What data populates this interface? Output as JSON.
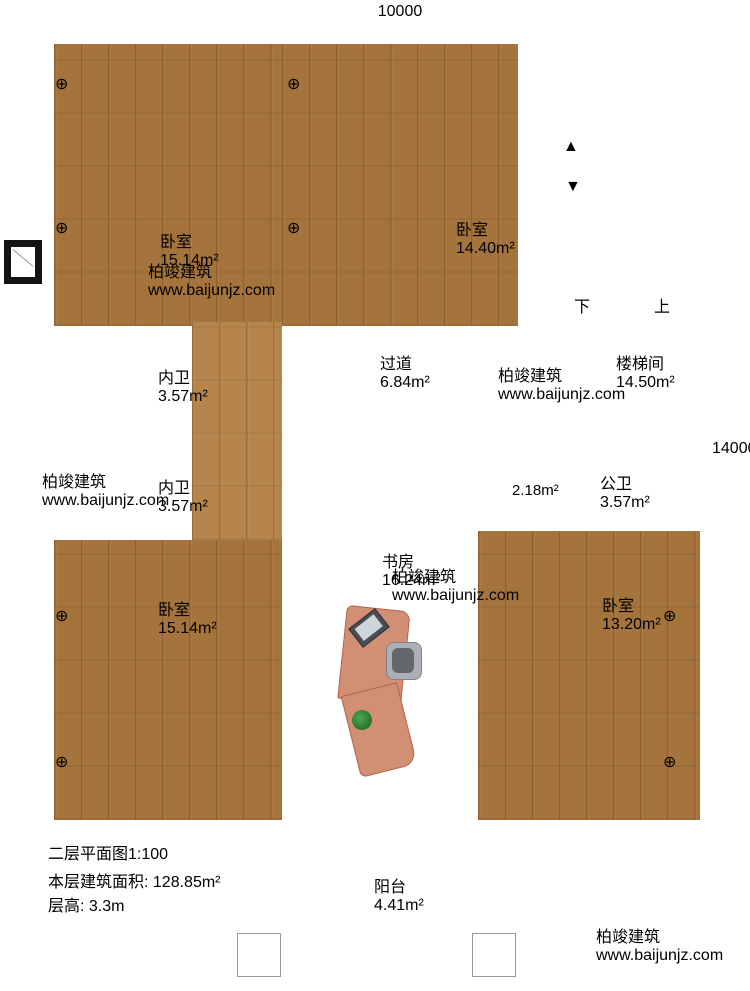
{
  "dimensions": {
    "top": "10000",
    "right": "14000"
  },
  "rooms": {
    "bedroom_top_left": {
      "name": "卧室",
      "area": "15.14m²"
    },
    "bedroom_top_mid": {
      "name": "卧室",
      "area": "14.40m²"
    },
    "stairwell": {
      "name": "楼梯间",
      "area": "14.50m²",
      "down": "下",
      "up": "上"
    },
    "hallway": {
      "name": "过道",
      "area": "6.84m²"
    },
    "ensuite_upper": {
      "name": "内卫",
      "area": "3.57m²"
    },
    "ensuite_lower": {
      "name": "内卫",
      "area": "3.57m²"
    },
    "public_bath": {
      "name": "公卫",
      "area": "3.57m²"
    },
    "vestibule": {
      "area": "2.18m²"
    },
    "study": {
      "name": "书房",
      "area": "16.24m²"
    },
    "bedroom_bottom_left": {
      "name": "卧室",
      "area": "15.14m²"
    },
    "bedroom_bottom_right": {
      "name": "卧室",
      "area": "13.20m²"
    },
    "balcony": {
      "name": "阳台",
      "area": "4.41m²"
    }
  },
  "title_block": {
    "title": "二层平面图",
    "scale": "1:100",
    "area_label": "本层建筑面积:",
    "area_value": "128.85m²",
    "height_label": "层高:",
    "height_value": "3.3m"
  },
  "brand": {
    "name": "柏竣建筑",
    "url": "www.baijunjz.com"
  },
  "watermark": {
    "name": "柏竣建筑",
    "url": "www.baijunjz.com"
  },
  "icons": {
    "lamp": "⊕",
    "arrow_up": "▲",
    "arrow_down": "▼"
  }
}
